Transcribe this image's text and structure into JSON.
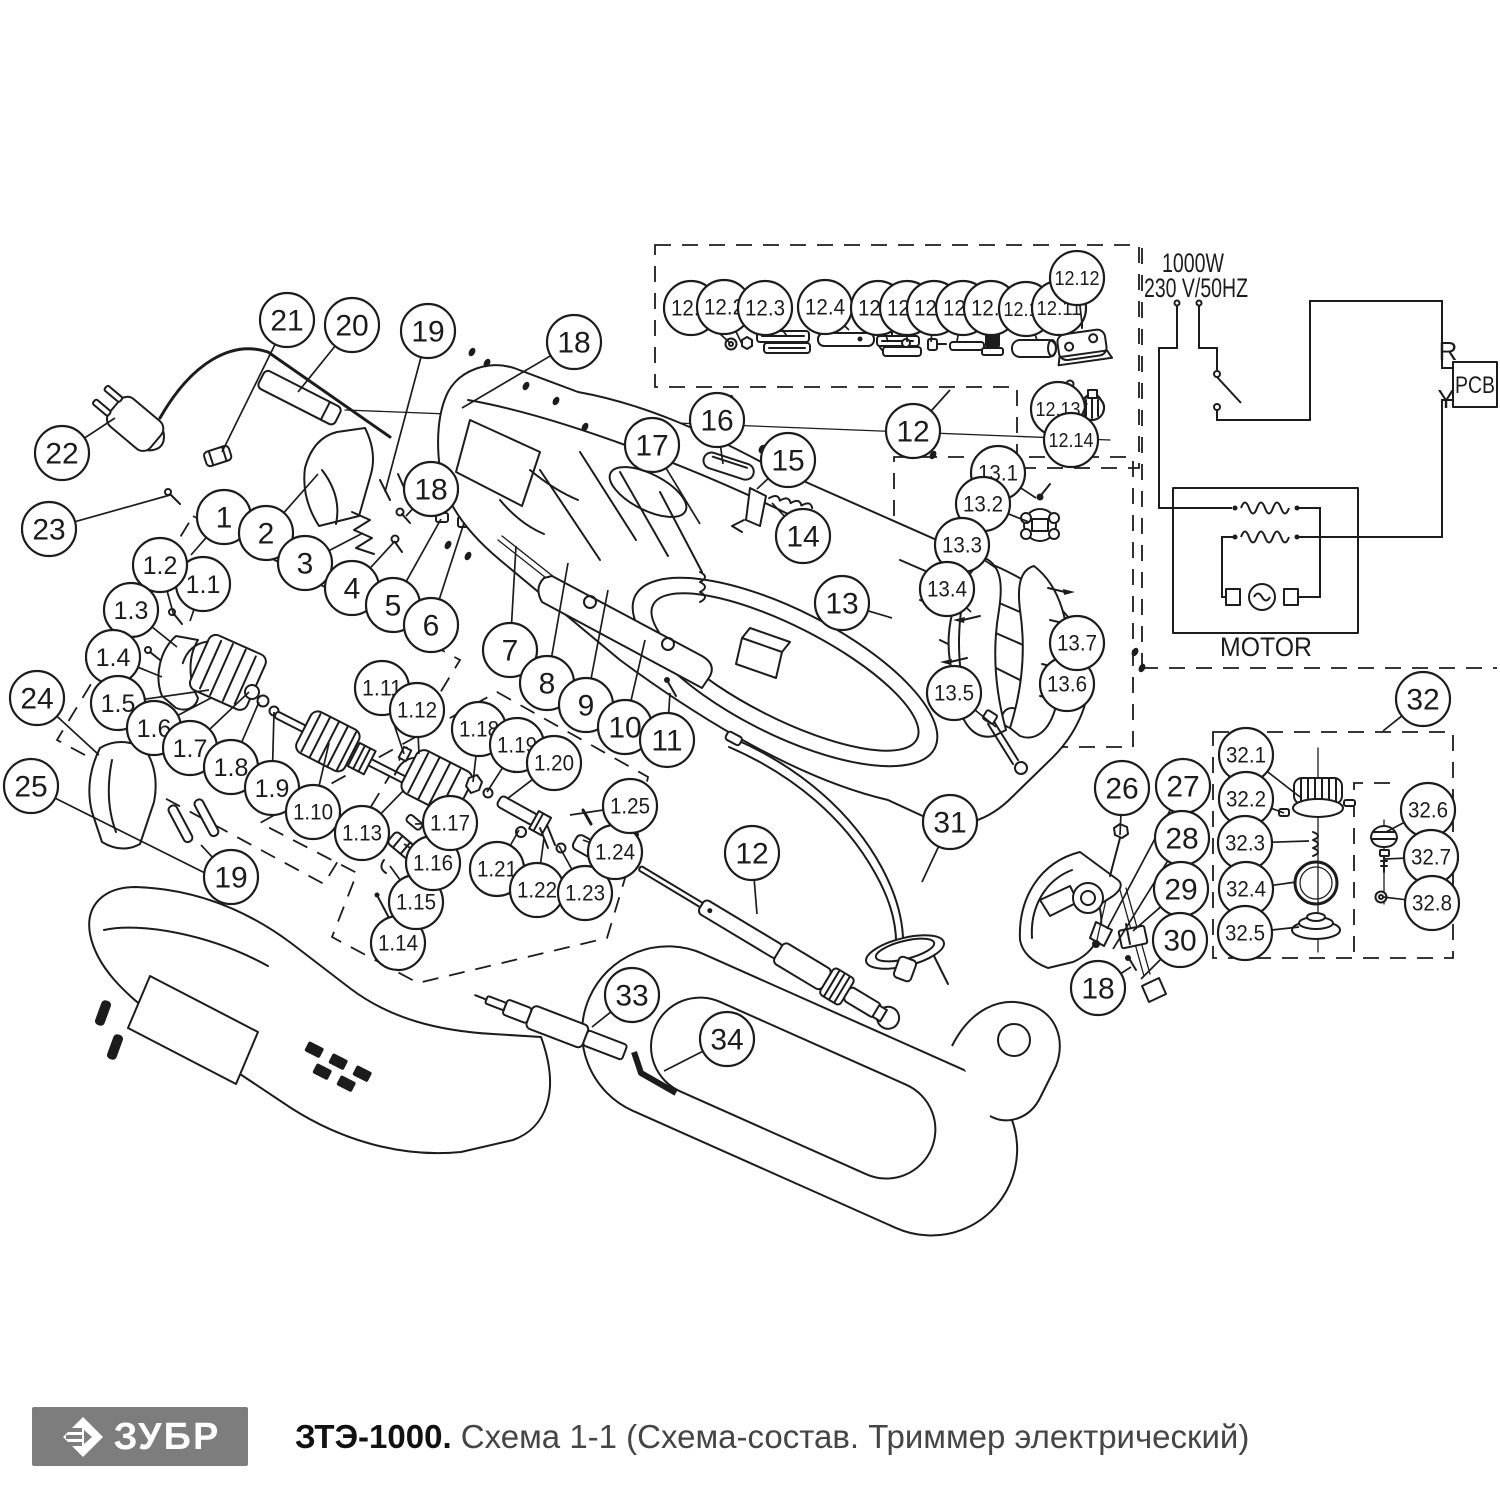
{
  "footer": {
    "logo": "ЗУБР",
    "model": "ЗТЭ-1000.",
    "caption": "Схема 1-1 (Схема-состав. Триммер электрический)"
  },
  "colors": {
    "line": "#1c1c1c",
    "logo_bg": "#7d7d7d",
    "caption_text": "#454545"
  },
  "wiring": {
    "power": "1000W",
    "supply": "230 V/50HZ",
    "r_label": "R",
    "y_label": "Y",
    "pcb_label": "PCB",
    "motor_label": "MOTOR"
  },
  "callouts": [
    {
      "n": "22",
      "x": 62,
      "y": 453,
      "tx": 115,
      "ty": 418
    },
    {
      "n": "21",
      "x": 287,
      "y": 320,
      "tx": 222,
      "ty": 452
    },
    {
      "n": "20",
      "x": 352,
      "y": 325,
      "tx": 298,
      "ty": 392
    },
    {
      "n": "19",
      "x": 428,
      "y": 331,
      "tx": 385,
      "ty": 492
    },
    {
      "n": "18",
      "x": 574,
      "y": 342,
      "tx": 462,
      "ty": 408
    },
    {
      "n": "23",
      "x": 49,
      "y": 529,
      "tx": 170,
      "ty": 495
    },
    {
      "n": "1",
      "x": 224,
      "y": 517,
      "tx": 191,
      "ty": 555
    },
    {
      "n": "2",
      "x": 266,
      "y": 533,
      "tx": 318,
      "ty": 474
    },
    {
      "n": "3",
      "x": 305,
      "y": 563,
      "tx": 363,
      "ty": 533
    },
    {
      "n": "4",
      "x": 352,
      "y": 588,
      "tx": 395,
      "ty": 541
    },
    {
      "n": "5",
      "x": 393,
      "y": 605,
      "tx": 441,
      "ty": 519
    },
    {
      "n": "6",
      "x": 431,
      "y": 625,
      "tx": 464,
      "ty": 523
    },
    {
      "n": "18",
      "x": 431,
      "y": 489,
      "tx": 406,
      "ty": 516
    },
    {
      "n": "7",
      "x": 510,
      "y": 650,
      "tx": 516,
      "ty": 546
    },
    {
      "n": "8",
      "x": 547,
      "y": 683,
      "tx": 568,
      "ty": 563
    },
    {
      "n": "9",
      "x": 586,
      "y": 705,
      "tx": 608,
      "ty": 590
    },
    {
      "n": "10",
      "x": 625,
      "y": 727,
      "tx": 645,
      "ty": 640
    },
    {
      "n": "11",
      "x": 667,
      "y": 740,
      "tx": 670,
      "ty": 693
    },
    {
      "n": "17",
      "x": 652,
      "y": 445,
      "tx": 700,
      "ty": 524
    },
    {
      "n": "16",
      "x": 717,
      "y": 420,
      "tx": 723,
      "ty": 464
    },
    {
      "n": "15",
      "x": 788,
      "y": 460,
      "tx": 757,
      "ty": 489
    },
    {
      "n": "14",
      "x": 803,
      "y": 536,
      "tx": 772,
      "ty": 503
    },
    {
      "n": "12",
      "x": 913,
      "y": 431,
      "tx": 950,
      "ty": 390
    },
    {
      "n": "12.1",
      "x": 691,
      "y": 308,
      "tx": 729,
      "ty": 342
    },
    {
      "n": "12.2",
      "x": 724,
      "y": 307,
      "tx": 742,
      "ty": 344
    },
    {
      "n": "12.3",
      "x": 765,
      "y": 308,
      "tx": 787,
      "ty": 336
    },
    {
      "n": "12.4",
      "x": 825,
      "y": 307,
      "tx": 849,
      "ty": 330
    },
    {
      "n": "12.5",
      "x": 878,
      "y": 308,
      "tx": 888,
      "ty": 342
    },
    {
      "n": "12.6",
      "x": 907,
      "y": 308,
      "tx": 907,
      "ty": 342
    },
    {
      "n": "12.7",
      "x": 934,
      "y": 308,
      "tx": 931,
      "ty": 342
    },
    {
      "n": "12.8",
      "x": 963,
      "y": 308,
      "tx": 957,
      "ty": 341
    },
    {
      "n": "12.9",
      "x": 991,
      "y": 308,
      "tx": 990,
      "ty": 337
    },
    {
      "n": "12.10",
      "x": 1026,
      "y": 309,
      "tx": 1037,
      "ty": 340
    },
    {
      "n": "12.11",
      "x": 1059,
      "y": 308,
      "tx": 1071,
      "ty": 333
    },
    {
      "n": "12.12",
      "x": 1077,
      "y": 278,
      "tx": 1082,
      "ty": 324
    },
    {
      "n": "12.13",
      "x": 1058,
      "y": 409,
      "tx": 1069,
      "ty": 393
    },
    {
      "n": "12.14",
      "x": 1071,
      "y": 440,
      "tx": 1087,
      "ty": 403
    },
    {
      "n": "13",
      "x": 842,
      "y": 603,
      "tx": 892,
      "ty": 618
    },
    {
      "n": "13.1",
      "x": 998,
      "y": 473,
      "tx": 1036,
      "ty": 498
    },
    {
      "n": "13.2",
      "x": 983,
      "y": 504,
      "tx": 1029,
      "ty": 522
    },
    {
      "n": "13.3",
      "x": 962,
      "y": 545,
      "tx": 996,
      "ty": 568
    },
    {
      "n": "13.4",
      "x": 947,
      "y": 589,
      "tx": 971,
      "ty": 612
    },
    {
      "n": "13.5",
      "x": 954,
      "y": 693,
      "tx": 996,
      "ty": 727
    },
    {
      "n": "13.6",
      "x": 1067,
      "y": 684,
      "tx": 1047,
      "ty": 673
    },
    {
      "n": "13.7",
      "x": 1077,
      "y": 643,
      "tx": 1048,
      "ty": 633
    },
    {
      "n": "24",
      "x": 37,
      "y": 698,
      "tx": 99,
      "ty": 755
    },
    {
      "n": "25",
      "x": 31,
      "y": 786,
      "tx": 249,
      "ty": 895
    },
    {
      "n": "19",
      "x": 231,
      "y": 877,
      "tx": 201,
      "ty": 845
    },
    {
      "n": "1.1",
      "x": 203,
      "y": 584,
      "tx": 190,
      "ty": 621
    },
    {
      "n": "1.2",
      "x": 160,
      "y": 565,
      "tx": 174,
      "ty": 616
    },
    {
      "n": "1.3",
      "x": 131,
      "y": 610,
      "tx": 177,
      "ty": 647
    },
    {
      "n": "1.4",
      "x": 113,
      "y": 657,
      "tx": 162,
      "ty": 677
    },
    {
      "n": "1.5",
      "x": 118,
      "y": 703,
      "tx": 209,
      "ty": 690
    },
    {
      "n": "1.6",
      "x": 154,
      "y": 728,
      "tx": 211,
      "ty": 698
    },
    {
      "n": "1.7",
      "x": 190,
      "y": 748,
      "tx": 249,
      "ty": 692
    },
    {
      "n": "1.8",
      "x": 231,
      "y": 767,
      "tx": 259,
      "ty": 702
    },
    {
      "n": "1.9",
      "x": 272,
      "y": 788,
      "tx": 274,
      "ty": 712
    },
    {
      "n": "1.10",
      "x": 313,
      "y": 812,
      "tx": 329,
      "ty": 743
    },
    {
      "n": "1.11",
      "x": 382,
      "y": 688,
      "tx": 404,
      "ty": 754
    },
    {
      "n": "1.12",
      "x": 417,
      "y": 710,
      "tx": 419,
      "ty": 754
    },
    {
      "n": "1.13",
      "x": 362,
      "y": 833,
      "tx": 404,
      "ty": 790
    },
    {
      "n": "1.14",
      "x": 398,
      "y": 943,
      "tx": 383,
      "ty": 916
    },
    {
      "n": "1.15",
      "x": 416,
      "y": 902,
      "tx": 390,
      "ty": 866
    },
    {
      "n": "1.16",
      "x": 433,
      "y": 863,
      "tx": 404,
      "ty": 844
    },
    {
      "n": "1.17",
      "x": 450,
      "y": 823,
      "tx": 415,
      "ty": 824
    },
    {
      "n": "1.18",
      "x": 479,
      "y": 729,
      "tx": 473,
      "ty": 782
    },
    {
      "n": "1.19",
      "x": 517,
      "y": 745,
      "tx": 487,
      "ty": 792
    },
    {
      "n": "1.20",
      "x": 554,
      "y": 763,
      "tx": 507,
      "ty": 799
    },
    {
      "n": "1.21",
      "x": 497,
      "y": 869,
      "tx": 519,
      "ty": 830
    },
    {
      "n": "1.22",
      "x": 537,
      "y": 890,
      "tx": 544,
      "ty": 838
    },
    {
      "n": "1.23",
      "x": 585,
      "y": 893,
      "tx": 559,
      "ty": 846
    },
    {
      "n": "1.24",
      "x": 615,
      "y": 852,
      "tx": 583,
      "ty": 840
    },
    {
      "n": "1.25",
      "x": 630,
      "y": 806,
      "tx": 570,
      "ty": 815
    },
    {
      "n": "12",
      "x": 752,
      "y": 853,
      "tx": 757,
      "ty": 914
    },
    {
      "n": "31",
      "x": 950,
      "y": 822,
      "tx": 922,
      "ty": 882
    },
    {
      "n": "33",
      "x": 632,
      "y": 995,
      "tx": 592,
      "ty": 1027
    },
    {
      "n": "34",
      "x": 727,
      "y": 1039,
      "tx": 664,
      "ty": 1071
    },
    {
      "n": "26",
      "x": 1122,
      "y": 788,
      "tx": 1120,
      "ty": 835
    },
    {
      "n": "27",
      "x": 1183,
      "y": 786,
      "tx": 1107,
      "ty": 929
    },
    {
      "n": "28",
      "x": 1182,
      "y": 838,
      "tx": 1113,
      "ty": 949
    },
    {
      "n": "29",
      "x": 1181,
      "y": 889,
      "tx": 1133,
      "ty": 931
    },
    {
      "n": "30",
      "x": 1180,
      "y": 940,
      "tx": 1141,
      "ty": 979
    },
    {
      "n": "18",
      "x": 1098,
      "y": 988,
      "tx": 1131,
      "ty": 967
    },
    {
      "n": "32",
      "x": 1423,
      "y": 699,
      "tx": 1383,
      "ty": 731
    },
    {
      "n": "32.1",
      "x": 1246,
      "y": 755,
      "tx": 1300,
      "ty": 797
    },
    {
      "n": "32.2",
      "x": 1246,
      "y": 799,
      "tx": 1284,
      "ty": 813
    },
    {
      "n": "32.3",
      "x": 1245,
      "y": 843,
      "tx": 1309,
      "ty": 841
    },
    {
      "n": "32.4",
      "x": 1246,
      "y": 889,
      "tx": 1296,
      "ty": 882
    },
    {
      "n": "32.5",
      "x": 1245,
      "y": 933,
      "tx": 1299,
      "ty": 927
    },
    {
      "n": "32.6",
      "x": 1428,
      "y": 810,
      "tx": 1386,
      "ty": 832
    },
    {
      "n": "32.7",
      "x": 1431,
      "y": 857,
      "tx": 1385,
      "ty": 859
    },
    {
      "n": "32.8",
      "x": 1432,
      "y": 903,
      "tx": 1383,
      "ty": 897
    }
  ]
}
